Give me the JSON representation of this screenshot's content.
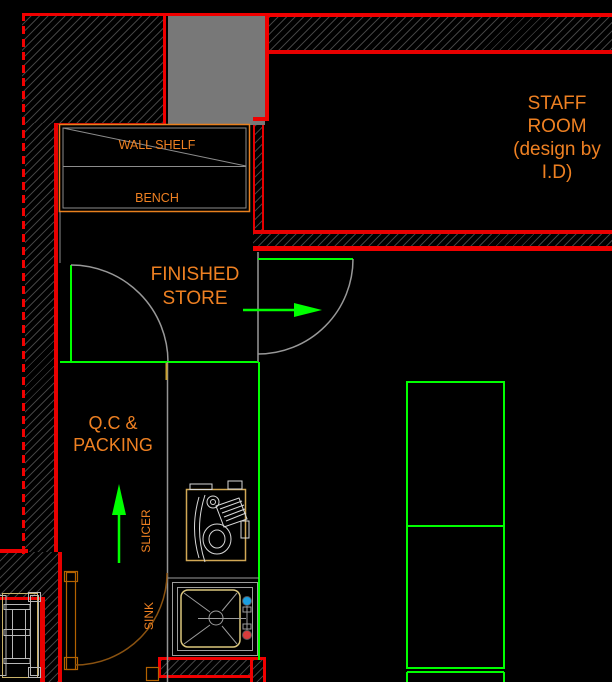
{
  "app": {
    "type": "cad-floor-plan-canvas",
    "background": "#000000"
  },
  "rooms": {
    "staff_room": {
      "lines": [
        "STAFF",
        "ROOM",
        "(design by",
        "I.D)"
      ]
    },
    "finished_store": {
      "lines": [
        "FINISHED",
        "STORE"
      ]
    },
    "qc_packing": {
      "lines": [
        "Q.C &",
        "PACKING"
      ]
    }
  },
  "furniture": {
    "wall_shelf": "WALL SHELF",
    "bench": "BENCH",
    "slicer": "SLICER",
    "sink": "SINK"
  },
  "flow_arrows": [
    {
      "area": "finished_store",
      "direction": "right"
    },
    {
      "area": "qc_packing",
      "direction": "up"
    }
  ],
  "colors": {
    "wall_red": "#F00000",
    "annotation_orange": "#EE8022",
    "flow_green": "#00FF00",
    "hatch_gray": "#414141",
    "solid_gray_fill": "#787878",
    "door_swing_gray": "#989898",
    "door_brown": "#B36200",
    "equipment_tan": "#D2A855",
    "sink_bowl_tan": "#DCC77E",
    "cold_water_blue": "#1B9FE0",
    "hot_water_red": "#D83C3C"
  }
}
